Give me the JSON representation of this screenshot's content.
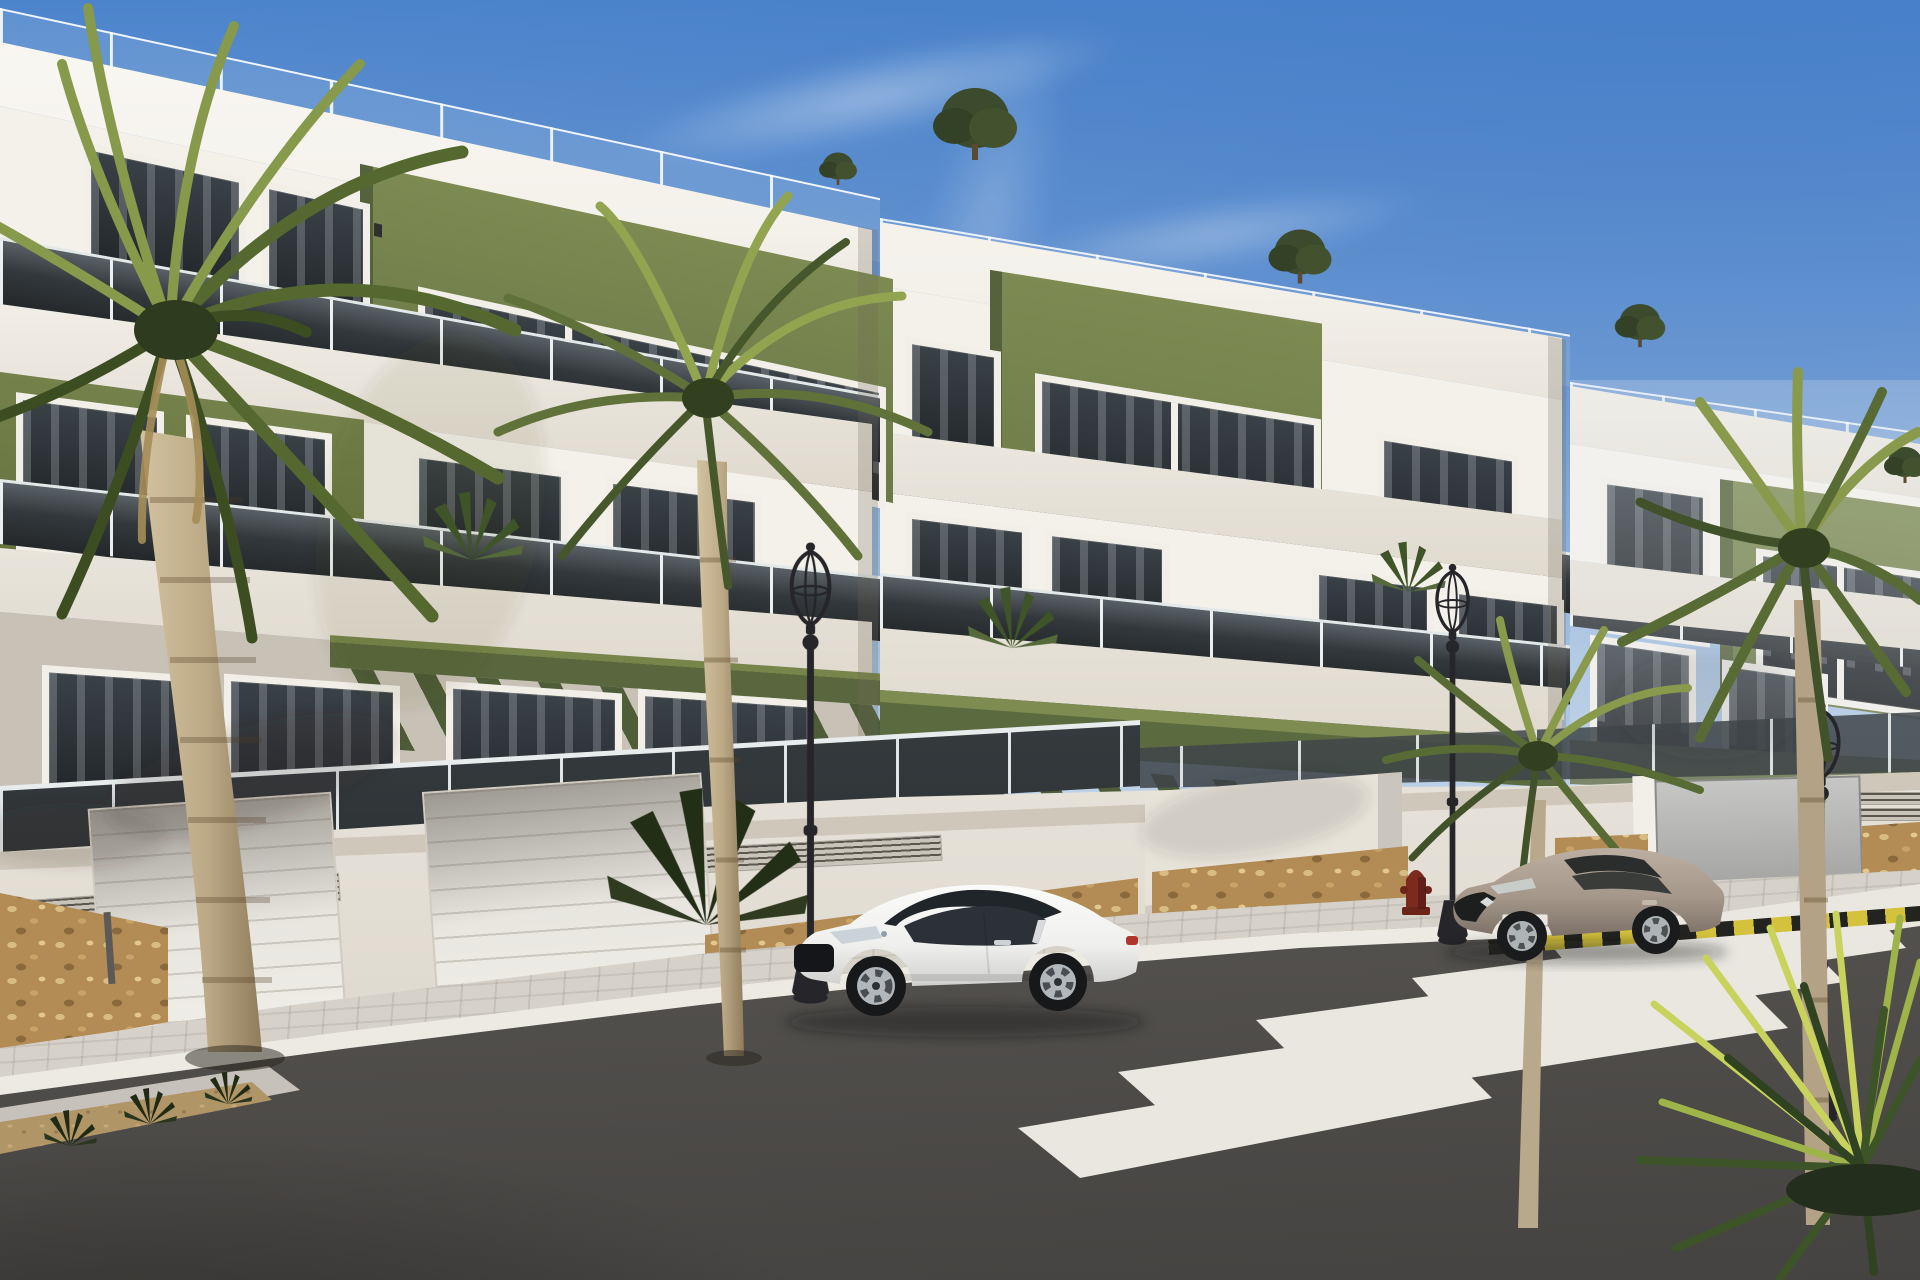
{
  "labels": {
    "scene": "3D architectural rendering of a modern three-storey apartment complex with olive-green accent panels, glass balconies, palm trees, two parked coupes, street lamps and a pedestrian crosswalk on a sunny street",
    "building_left": "left apartment block with rooftop glass balustrade, green accent panels and garage level",
    "building_center": "center apartment block with stepped balconies and green pergola",
    "building_right": "distant right apartment block",
    "street_wall": "white street-level wall with stone-clad base and vent grilles",
    "garage_doors": "two white sectional garage doors",
    "sidewalk": "paved sidewalk with light concrete curb",
    "road": "asphalt street",
    "crosswalk": "white zebra crosswalk stripes",
    "curb_marking": "yellow and black painted no-parking curb",
    "car_white": "white sports coupe parked at the curb",
    "car_beige": "beige coupe parked near the crosswalk",
    "street_lamps": "classic black street lanterns",
    "fire_hydrant": "dark red fire hydrant on the sidewalk",
    "palm_trees": "palm trees along the street",
    "yucca": "spiky yucca plant in the foreground corner",
    "planter": "gravel planter strip at lower left",
    "rooftop_shrubs": "small trees on the rooftop terraces"
  },
  "objects": {
    "building_blocks": 3,
    "storeys_per_block": 3,
    "garage_doors": 2,
    "street_lamps": 3,
    "palm_trees": 4,
    "rooftop_shrubs": 5,
    "crosswalk_stripes": 6,
    "cars": [
      {
        "type": "sports coupe",
        "color": "white",
        "facing": "left"
      },
      {
        "type": "coupe",
        "color": "beige",
        "facing": "left"
      }
    ],
    "fire_hydrants": 1,
    "sky": "clear blue with thin wispy clouds"
  },
  "palette": {
    "skyTop": "#477fc8",
    "skyMid": "#7aa2d6",
    "skyHaze": "#e9eff6",
    "wallLit": "#f4f1eb",
    "wallMid": "#e9e5dd",
    "wallShade": "#c8c2b6",
    "cornice": "#faf8f3",
    "greenLit": "#7d8a52",
    "greenMid": "#6b7847",
    "greenDark": "#55623c",
    "greenBand": "#5c6a40",
    "glassTop": "#5a6166",
    "glassDark": "#24282b",
    "frame": "#f2efe9",
    "stone": "#b28c54",
    "stoneLight": "#d9bc84",
    "stoneDark": "#8a6a3c",
    "paver": "#d6d2ca",
    "curb": "#eceae3",
    "roadLight": "#7b7873",
    "roadMid": "#615e5a",
    "roadDark": "#454341",
    "stripe": "#e9e7e0",
    "markYellow": "#d4c13c",
    "markBlack": "#23231f",
    "lamp": "#26262a",
    "hydrant": "#7c2a1e",
    "carWhite": "#f3f3f1",
    "carTaupe": "#a89a8b",
    "palmLight": "#93a451",
    "palmMid": "#60713a",
    "palmDark": "#3c4d22",
    "trunkLight": "#c7b592",
    "trunkDark": "#8f7c5c"
  }
}
